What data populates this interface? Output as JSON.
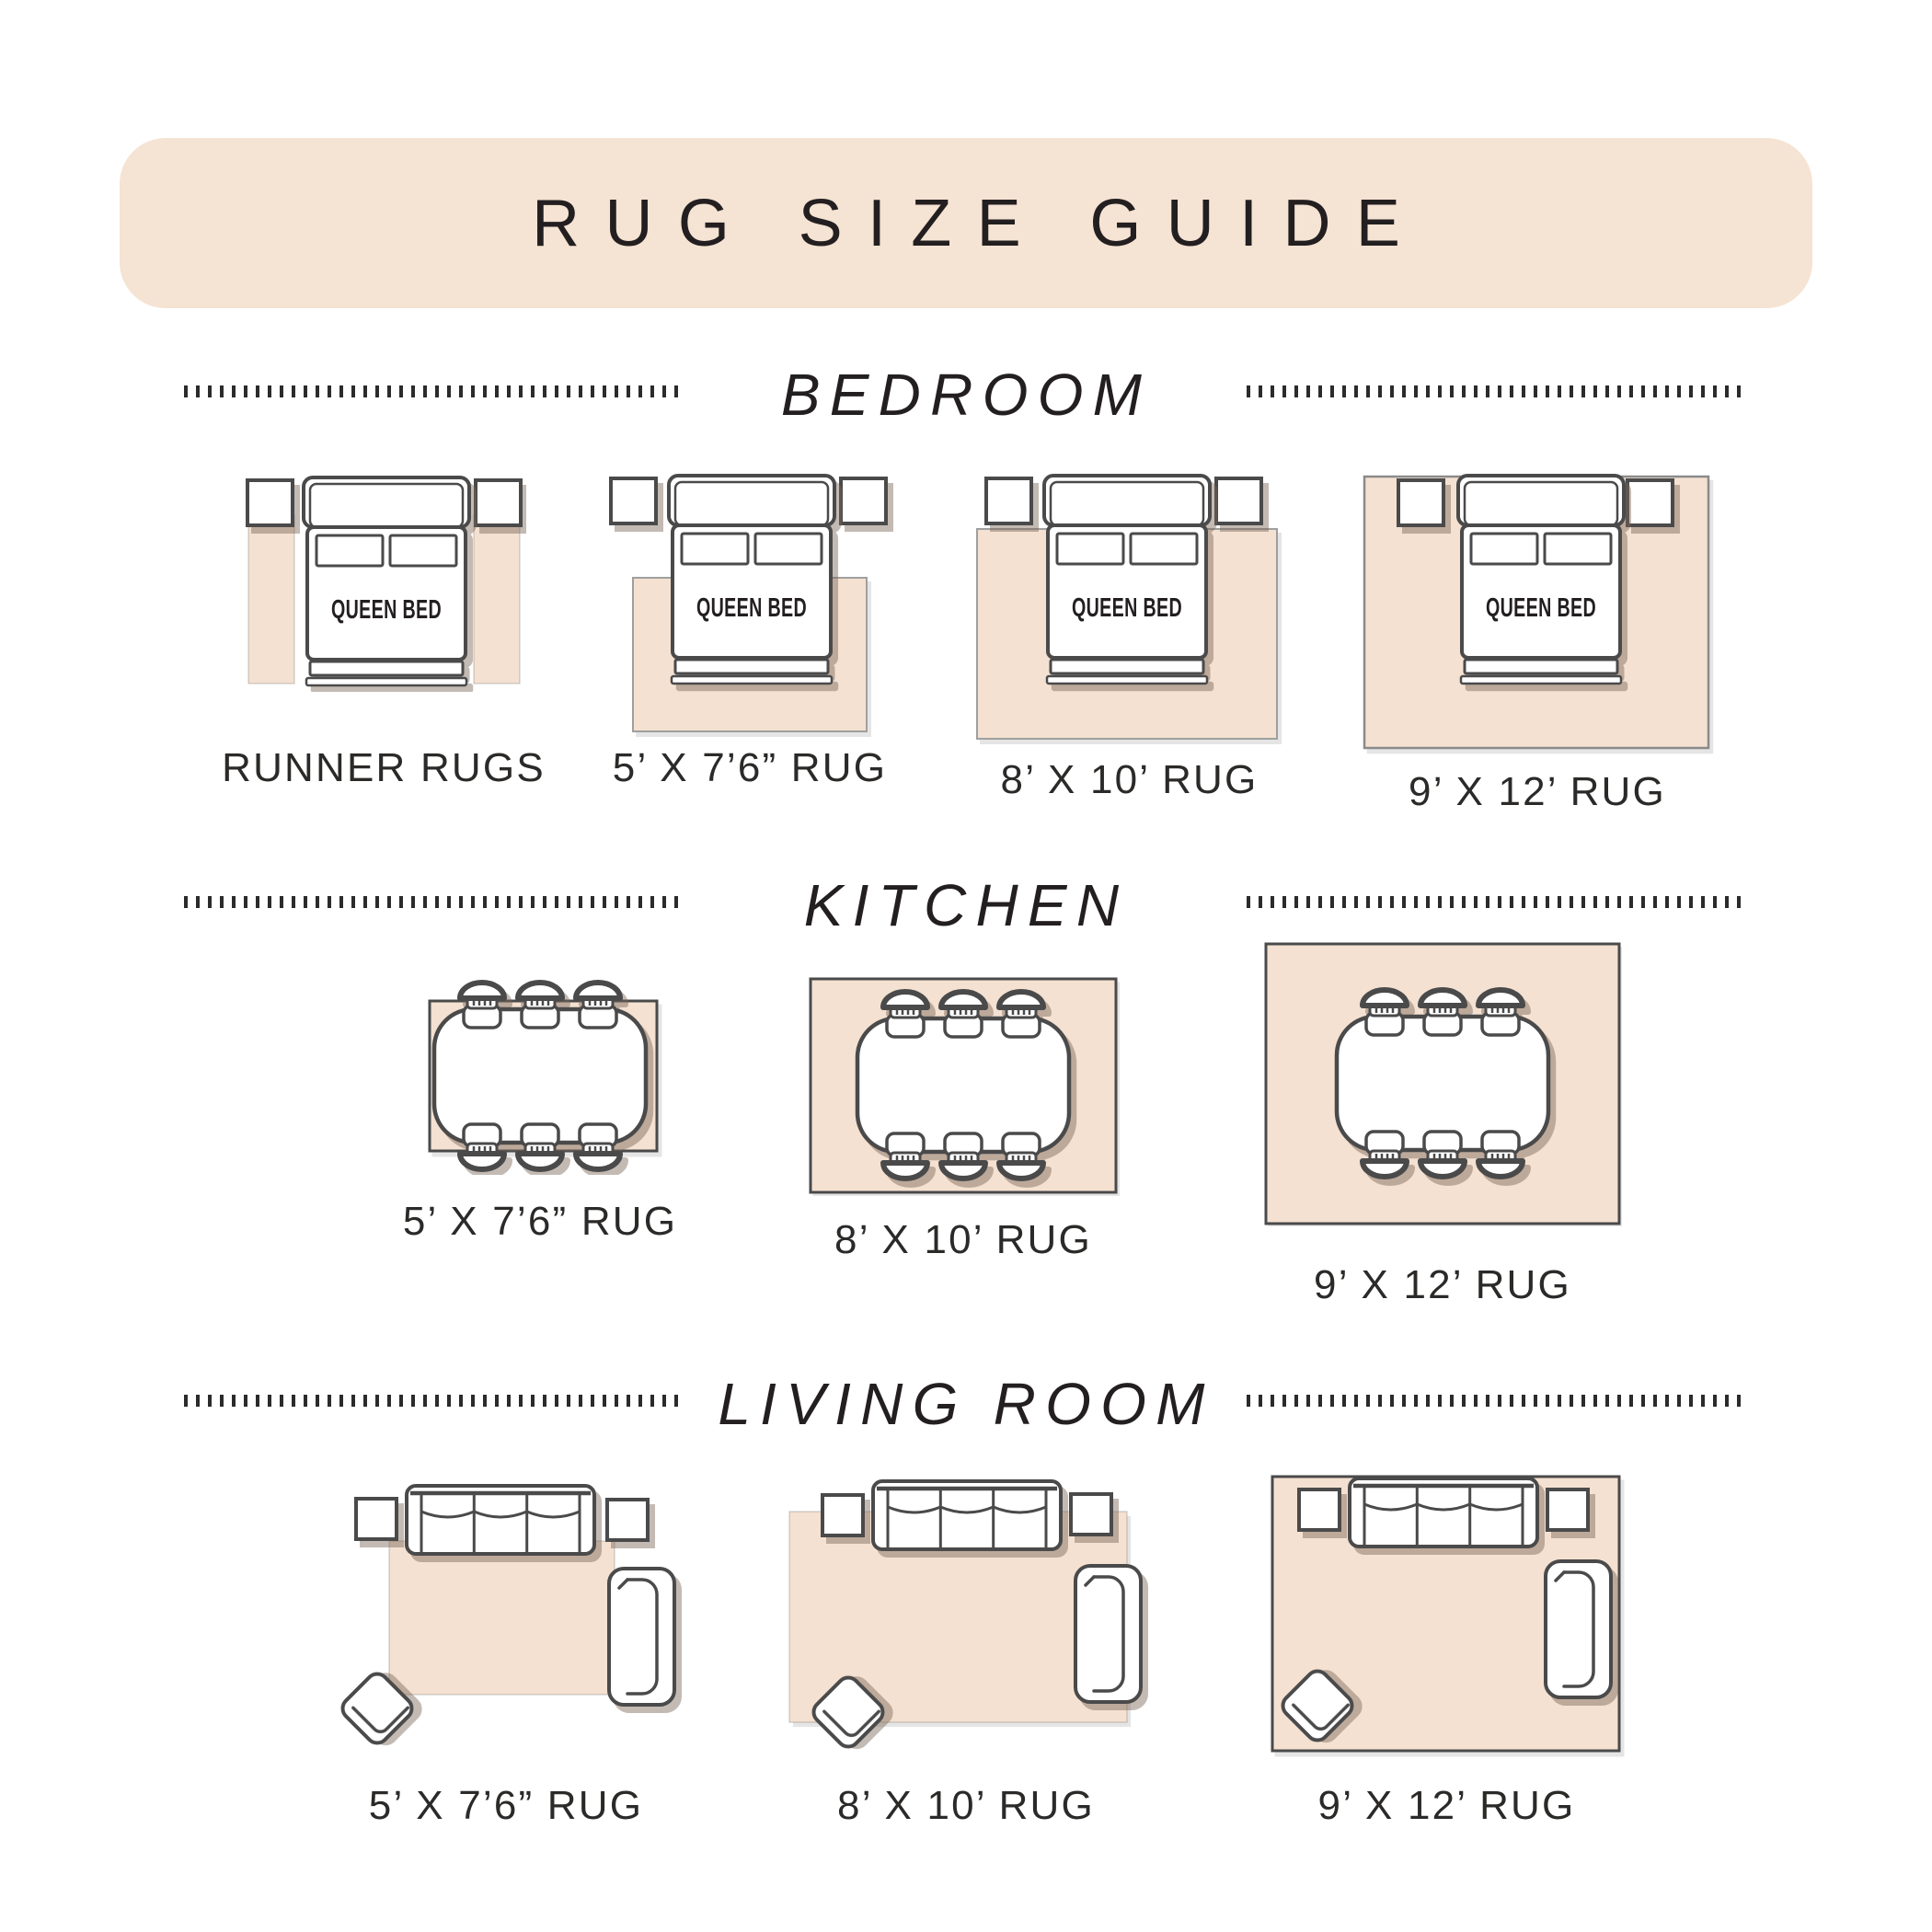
{
  "title": "RUG SIZE GUIDE",
  "sections": {
    "bedroom": {
      "title": "BEDROOM",
      "bed_label": "QUEEN BED",
      "items": [
        {
          "label": "RUNNER RUGS"
        },
        {
          "label": "5’ X 7’6” RUG"
        },
        {
          "label": "8’ X 10’ RUG"
        },
        {
          "label": "9’ X 12’ RUG"
        }
      ]
    },
    "kitchen": {
      "title": "KITCHEN",
      "items": [
        {
          "label": "5’ X 7’6” RUG"
        },
        {
          "label": "8’ X 10’ RUG"
        },
        {
          "label": "9’ X 12’ RUG"
        }
      ]
    },
    "living_room": {
      "title": "LIVING ROOM",
      "items": [
        {
          "label": "5’ X 7’6” RUG"
        },
        {
          "label": "8’ X 10’ RUG"
        },
        {
          "label": "9’ X 12’ RUG"
        }
      ]
    }
  },
  "colors": {
    "banner_bg": "#f5e3d3",
    "rug_fill": "#f4e1d1",
    "furniture_outline": "#4a4a4b",
    "furniture_shadow": "#b9a493",
    "text": "#231f20"
  }
}
